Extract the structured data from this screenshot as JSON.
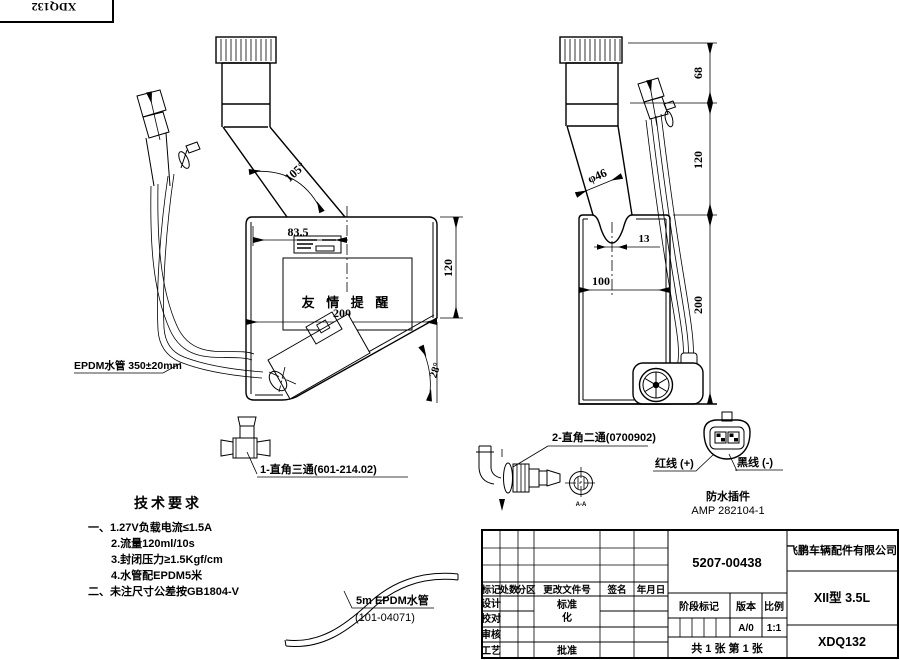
{
  "corner": {
    "code": "XDQ132"
  },
  "left_view": {
    "dim_top_width": "83.5",
    "dim_neck_angle": "105°",
    "dim_height": "120",
    "dim_width": "200",
    "dim_bottom_angle": "28°",
    "reminder_label": "友 情 提 醒",
    "hose_note": "EPDM水管 350±20mm",
    "tee_label": "1-直角三通(601-214.02)"
  },
  "right_view": {
    "dim_cap": "68",
    "dim_neck": "120",
    "dim_height": "200",
    "dim_width": "100",
    "dim_notch": "13",
    "dim_dia": "φ46",
    "elbow_label": "2-直角二通(0700902)",
    "section_label": "A-A",
    "connector": {
      "red_wire": "红线 (+)",
      "black_wire": "黑线 (-)",
      "name": "防水插件",
      "model": "AMP 282104-1"
    }
  },
  "hose_detail": {
    "label": "5m  EPDM水管",
    "part_no": "(101-04071)"
  },
  "tech_requirements": {
    "title": "技术要求",
    "items": [
      "一、1.27V负载电流≤1.5A",
      "2.流量120ml/10s",
      "3.封闭压力≥1.5Kgf/cm",
      "4.水管配EPDM5米",
      "二、未注尺寸公差按GB1804-V"
    ]
  },
  "title_block": {
    "drawing_no": "5207-00438",
    "company": "飞鹏车辆配件有限公司",
    "model": "XII型 3.5L",
    "part_no": "XDQ132",
    "rev_headers": [
      "标记",
      "处数",
      "分区",
      "更改文件号",
      "签名",
      "年月日"
    ],
    "row_labels": [
      "设计",
      "校对",
      "审核",
      "工艺"
    ],
    "std_label_1": "标准",
    "std_label_2": "化",
    "approve_label": "批准",
    "stage_header": "阶段标记",
    "version_header": "版本",
    "scale_header": "比例",
    "version": "A/0",
    "scale": "1:1",
    "sheet_info": "共 1 张  第 1 张"
  }
}
